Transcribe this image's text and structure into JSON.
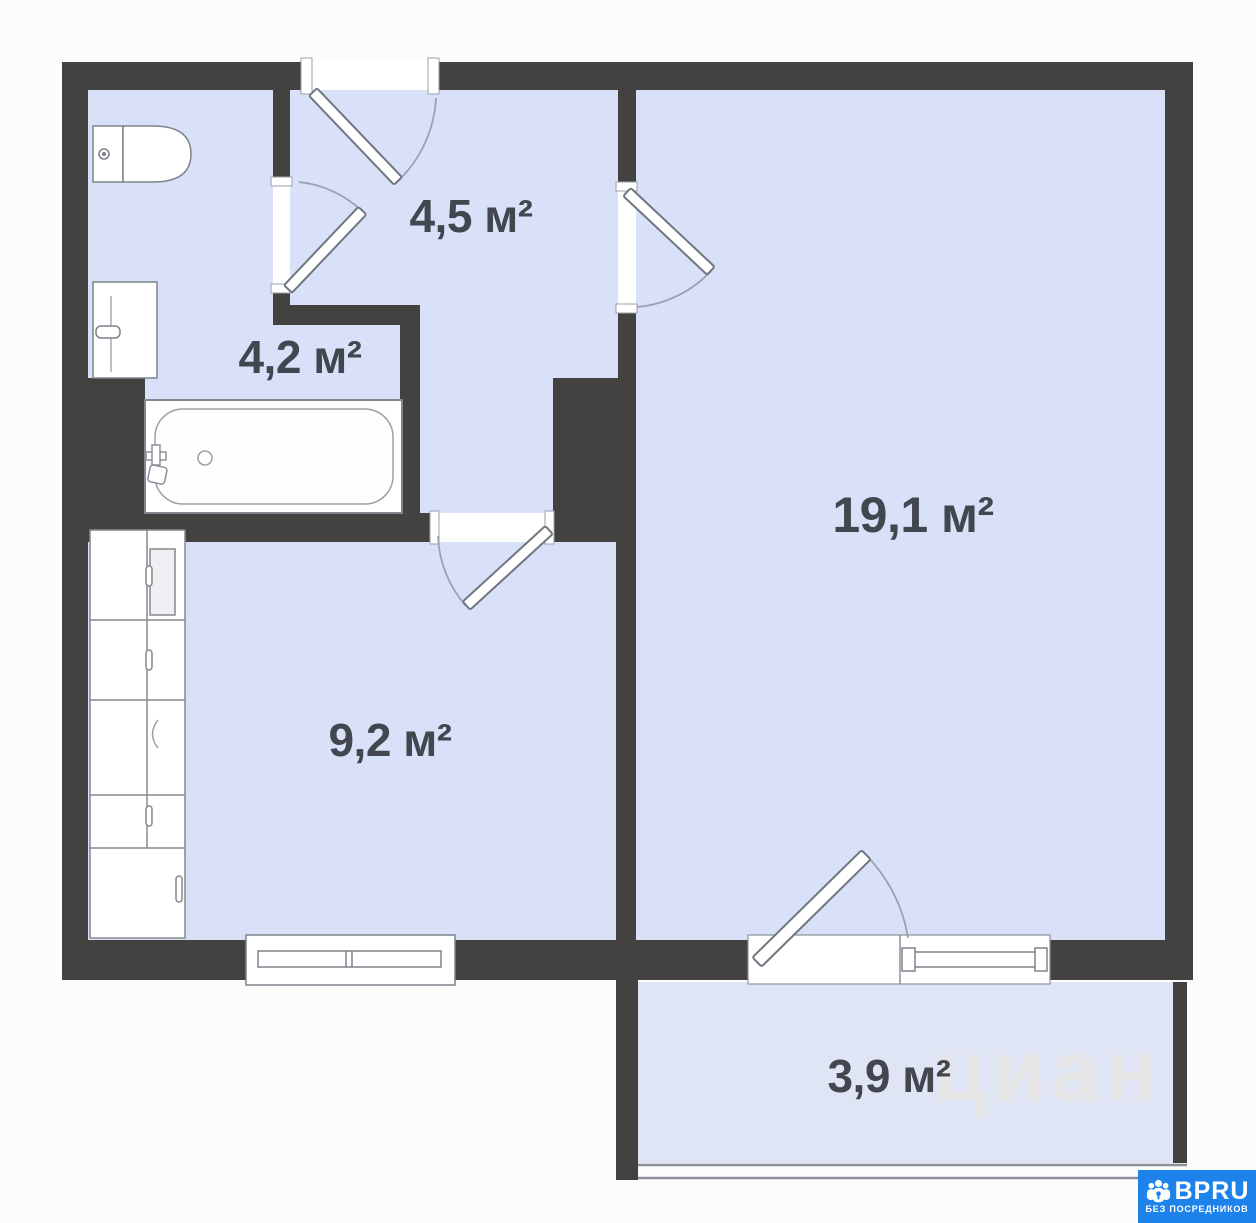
{
  "floor_plan": {
    "watermark_text": "циан",
    "rooms": [
      {
        "id": "hallway",
        "area": "4,5 м²"
      },
      {
        "id": "bathroom",
        "area": "4,2 м²"
      },
      {
        "id": "living-room",
        "area": "19,1 м²"
      },
      {
        "id": "kitchen",
        "area": "9,2 м²"
      },
      {
        "id": "balcony",
        "area": "3,9 м²"
      }
    ]
  },
  "branding": {
    "logo_text": "BPRU",
    "tagline": "БЕЗ ПОСРЕДНИКОВ",
    "badge_color": "#1d83eb"
  },
  "colors": {
    "wall": "#434240",
    "room_floor": "#d8e1f7",
    "balcony_floor": "#dfe5f4",
    "fixture_outline": "#7c828e"
  }
}
